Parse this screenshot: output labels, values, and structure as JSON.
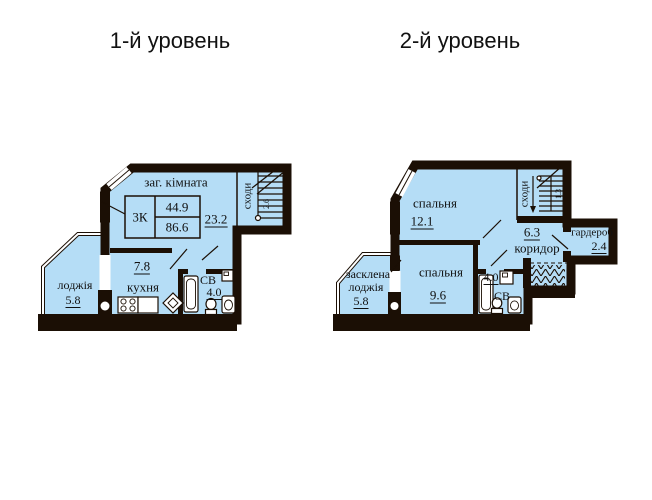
{
  "titles": {
    "level1": "1-й уровень",
    "level2": "2-й уровень"
  },
  "palette": {
    "room_fill": "#b5ddf6",
    "wall": "#1b0f05",
    "text": "#101010",
    "background": "#ffffff"
  },
  "level1": {
    "info_box": {
      "apartment_type": "3К",
      "living_area": "44.9",
      "total_area": "86.6"
    },
    "labels": {
      "living_room": "заг. кімната",
      "living_room_area": "23.2",
      "hall_area": "7.8",
      "kitchen": "кухня",
      "loggia": "лоджія",
      "loggia_area": "5.8",
      "bathroom": "СВ",
      "bathroom_area": "4.0",
      "stairs": "сходи",
      "stairs_dim": "2.6"
    }
  },
  "level2": {
    "labels": {
      "bedroom1": "спальня",
      "bedroom1_area": "12.1",
      "bedroom2": "спальня",
      "bedroom2_area": "9.6",
      "loggia_line1": "засклена",
      "loggia_line2": "лоджія",
      "loggia_area": "5.8",
      "bathroom": "СВ",
      "bathroom_area": "4.0",
      "corridor": "коридор",
      "corridor_area": "6.3",
      "wardrobe": "гардероб",
      "wardrobe_area": "2.4",
      "stairs": "сходи",
      "stairs_dim": "1.3"
    }
  }
}
